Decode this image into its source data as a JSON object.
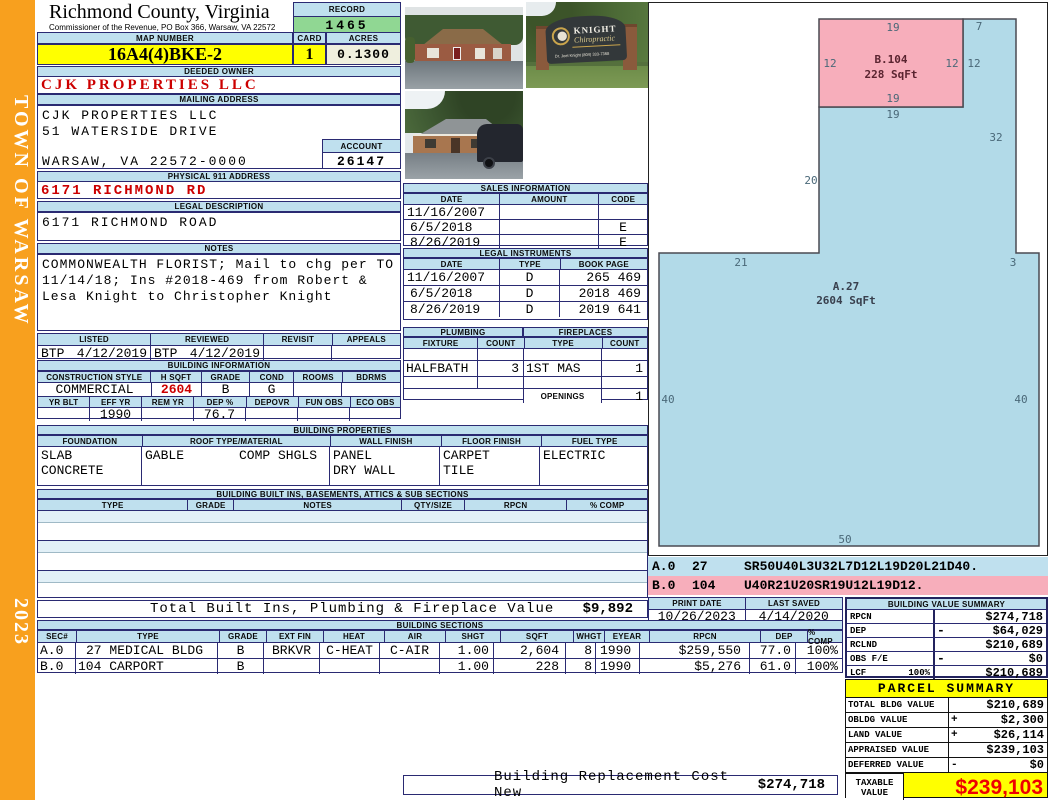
{
  "colors": {
    "sidebar_orange": "#F8A01E",
    "header_blue": "#BFE0EE",
    "record_green": "#90D793",
    "highlight_yellow": "#FFFF00",
    "acres_cream": "#EFEFDE",
    "value_red": "#CC0000",
    "sketch_blue": "#B2DAE8",
    "sketch_pink": "#F7AEBB"
  },
  "sidebar": {
    "title": "TOWN OF WARSAW",
    "year": "2023"
  },
  "header": {
    "county": "Richmond County, Virginia",
    "commissioner": "Commissioner of the Revenue, PO Box 366, Warsaw, VA 22572",
    "record_label": "RECORD",
    "record_value": "1465",
    "map_number_label": "MAP NUMBER",
    "map_number": "16A4(4)BKE-2",
    "card_label": "CARD",
    "card_value": "1",
    "acres_label": "ACRES",
    "acres_value": "0.1300"
  },
  "owner": {
    "deeded_owner_label": "DEEDED OWNER",
    "deeded_owner": "CJK PROPERTIES LLC",
    "mailing_label": "MAILING ADDRESS",
    "mailing_line1": "CJK PROPERTIES LLC",
    "mailing_line2": "51 WATERSIDE DRIVE",
    "mailing_line3": "",
    "mailing_line4": "WARSAW, VA 22572-0000",
    "account_label": "ACCOUNT",
    "account_value": "26147",
    "physical_label": "PHYSICAL 911 ADDRESS",
    "physical_address": "6171 RICHMOND RD",
    "legal_label": "LEGAL DESCRIPTION",
    "legal_description": "6171 RICHMOND ROAD",
    "notes_label": "NOTES",
    "notes_line1": "COMMONWEALTH FLORIST; Mail to chg per TO",
    "notes_line2": "11/14/18; Ins #2018-469 from Robert &",
    "notes_line3": "Lesa Knight to Christopher Knight"
  },
  "review": {
    "listed_label": "LISTED",
    "reviewed_label": "REVIEWED",
    "revisit_label": "REVISIT",
    "appeals_label": "APPEALS",
    "listed_by": "BTP",
    "listed_date": "4/12/2019",
    "reviewed_by": "BTP",
    "reviewed_date": "4/12/2019",
    "revisit_value": "",
    "appeals_value": ""
  },
  "building_info": {
    "title": "BUILDING INFORMATION",
    "h1": [
      "CONSTRUCTION STYLE",
      "H SQFT",
      "GRADE",
      "COND",
      "ROOMS",
      "BDRMS"
    ],
    "v1": [
      "COMMERCIAL",
      "2604",
      "B",
      "G",
      "",
      ""
    ],
    "h2": [
      "YR BLT",
      "EFF YR",
      "REM YR",
      "DEP %",
      "DEPOVR",
      "FUN OBS",
      "ECO OBS"
    ],
    "v2": [
      "",
      "1990",
      "",
      "76.7",
      "",
      "",
      ""
    ]
  },
  "building_properties": {
    "title": "BUILDING PROPERTIES",
    "foundation_label": "FOUNDATION",
    "foundation_1": "SLAB",
    "foundation_2": "CONCRETE",
    "roof_label": "ROOF TYPE/MATERIAL",
    "roof_1": "GABLE",
    "roof_2": "COMP SHGLS",
    "wall_label": "WALL FINISH",
    "wall_1": "PANEL",
    "wall_2": "DRY WALL",
    "floor_label": "FLOOR FINISH",
    "floor_1": "CARPET",
    "floor_2": "TILE",
    "fuel_label": "FUEL TYPE",
    "fuel_1": "ELECTRIC"
  },
  "built_ins": {
    "title": "BUILDING BUILT INS, BASEMENTS, ATTICS & SUB SECTIONS",
    "headers": [
      "TYPE",
      "GRADE",
      "NOTES",
      "QTY/SIZE",
      "RPCN",
      "% COMP"
    ],
    "total_label": "Total Built Ins, Plumbing & Fireplace Value",
    "total_value": "$9,892"
  },
  "photos": {
    "sign_line1": "KNIGHT",
    "sign_line2": "Chiropractic",
    "sign_line3": "Dr. Joel Knight   (804) 333-7368"
  },
  "sales": {
    "title": "SALES INFORMATION",
    "headers": [
      "DATE",
      "AMOUNT",
      "CODE"
    ],
    "rows": [
      {
        "date": "11/16/2007",
        "amount": "",
        "code": ""
      },
      {
        "date": "6/5/2018",
        "amount": "",
        "code": "E"
      },
      {
        "date": "8/26/2019",
        "amount": "",
        "code": "E"
      }
    ]
  },
  "legal_instruments": {
    "title": "LEGAL INSTRUMENTS",
    "headers": [
      "DATE",
      "TYPE",
      "BOOK PAGE"
    ],
    "rows": [
      {
        "date": "11/16/2007",
        "type": "D",
        "book_page": "265 469"
      },
      {
        "date": "6/5/2018",
        "type": "D",
        "book_page": "2018 469"
      },
      {
        "date": "8/26/2019",
        "type": "D",
        "book_page": "2019 641"
      }
    ]
  },
  "plumbing": {
    "title": "PLUMBING",
    "fixture_label": "FIXTURE",
    "count_label": "COUNT",
    "fixture": "HALFBATH",
    "fixture_count": "3"
  },
  "fireplaces": {
    "title": "FIREPLACES",
    "type_label": "TYPE",
    "count_label": "COUNT",
    "type": "1ST MAS",
    "type_count": "1",
    "openings_label": "OPENINGS",
    "openings_count": "1"
  },
  "sketch": {
    "section_a_label": "A.27",
    "section_a_sqft": "2604 SqFt",
    "section_b_label": "B.104",
    "section_b_sqft": "228 SqFt",
    "dims": {
      "b_top": "19",
      "a_top7": "7",
      "b_left": "12",
      "b_right": "12",
      "a_right12": "12",
      "b_bottom": "19",
      "a_below_b": "19",
      "a_right32": "32",
      "a_left20": "20",
      "a_top21": "21",
      "a_top3": "3",
      "a_left40": "40",
      "a_right40": "40",
      "a_bottom50": "50"
    },
    "codes": [
      {
        "sec": "A.0",
        "num": "27",
        "code": "SR50U40L3U32L7D12L19D20L21D40."
      },
      {
        "sec": "B.0",
        "num": "104",
        "code": "U40R21U20SR19U12L19D12."
      }
    ]
  },
  "print_info": {
    "print_date_label": "PRINT DATE",
    "print_date": "10/26/2023",
    "last_saved_label": "LAST SAVED",
    "last_saved": "4/14/2020"
  },
  "building_value_summary": {
    "title": "BUILDING VALUE SUMMARY",
    "rows": [
      {
        "label": "RPCN",
        "extra": "",
        "sign": "",
        "value": "$274,718"
      },
      {
        "label": "DEP",
        "extra": "",
        "sign": "-",
        "value": "$64,029"
      },
      {
        "label": "RCLND",
        "extra": "",
        "sign": "",
        "value": "$210,689"
      },
      {
        "label": "OBS F/E",
        "extra": "",
        "sign": "-",
        "value": "$0"
      },
      {
        "label": "LCF",
        "extra": "100%",
        "sign": "",
        "value": "$210,689"
      }
    ]
  },
  "building_sections": {
    "title": "BUILDING SECTIONS",
    "headers": [
      "SEC#",
      "TYPE",
      "GRADE",
      "EXT FIN",
      "HEAT",
      "AIR",
      "SHGT",
      "SQFT",
      "WHGT",
      "EYEAR",
      "RPCN",
      "DEP",
      "% COMP"
    ],
    "rows": [
      {
        "sec": "A.0",
        "type": "27 MEDICAL BLDG",
        "grade": "B",
        "ext_fin": "BRKVR",
        "heat": "C-HEAT",
        "air": "C-AIR",
        "shgt": "1.00",
        "sqft": "2,604",
        "whgt": "8",
        "eyear": "1990",
        "rpcn": "$259,550",
        "dep": "77.0",
        "comp": "100%"
      },
      {
        "sec": "B.0",
        "type": "104 CARPORT",
        "grade": "B",
        "ext_fin": "",
        "heat": "",
        "air": "",
        "shgt": "1.00",
        "sqft": "228",
        "whgt": "8",
        "eyear": "1990",
        "rpcn": "$5,276",
        "dep": "61.0",
        "comp": "100%"
      }
    ]
  },
  "parcel_summary": {
    "title": "PARCEL SUMMARY",
    "rows": [
      {
        "label": "TOTAL BLDG VALUE",
        "sign": "",
        "value": "$210,689"
      },
      {
        "label": "OBLDG VALUE",
        "sign": "+",
        "value": "$2,300"
      },
      {
        "label": "LAND VALUE",
        "sign": "+",
        "value": "$26,114"
      },
      {
        "label": "APPRAISED VALUE",
        "sign": "",
        "value": "$239,103"
      },
      {
        "label": "DEFERRED VALUE",
        "sign": "-",
        "value": "$0"
      }
    ],
    "taxable_label_1": "TAXABLE",
    "taxable_label_2": "VALUE",
    "taxable_value": "$239,103"
  },
  "footer": {
    "label": "Building Replacement Cost New",
    "value": "$274,718"
  }
}
